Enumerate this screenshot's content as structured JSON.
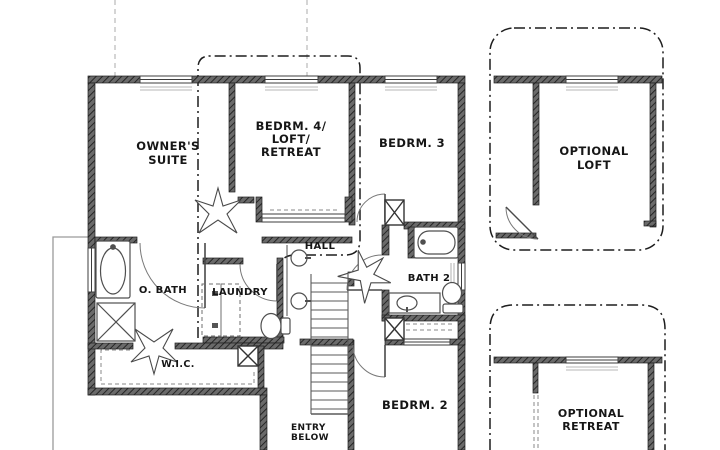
{
  "drawing_title": "second-floor-plan",
  "colors": {
    "wall_dark": "#4a4a4a",
    "wall_hatch_line": "#262626",
    "line_dark": "#1d1d1d",
    "fixture_line": "#5a5a5a",
    "guide_gray": "#b9b9b9",
    "background": "#ffffff"
  },
  "rooms": [
    {
      "id": "owners-suite",
      "lines": [
        "OWNER'S",
        "SUITE"
      ],
      "x": 168,
      "y": 150,
      "size": 11.5,
      "lh": 14,
      "anchor": "middle"
    },
    {
      "id": "bedrm4-loft-retreat",
      "lines": [
        "BEDRM. 4/",
        "LOFT/",
        "RETREAT"
      ],
      "x": 291,
      "y": 130,
      "size": 11.5,
      "lh": 13,
      "anchor": "middle"
    },
    {
      "id": "bedrm3",
      "lines": [
        "BEDRM. 3"
      ],
      "x": 412,
      "y": 147,
      "size": 11.5,
      "lh": 13,
      "anchor": "middle"
    },
    {
      "id": "optional-loft",
      "lines": [
        "OPTIONAL",
        "LOFT"
      ],
      "x": 594,
      "y": 155,
      "size": 11.5,
      "lh": 14,
      "anchor": "middle"
    },
    {
      "id": "hall",
      "lines": [
        "HALL"
      ],
      "x": 320,
      "y": 249,
      "size": 10,
      "lh": 11,
      "anchor": "middle"
    },
    {
      "id": "o-bath",
      "lines": [
        "O. BATH"
      ],
      "x": 163,
      "y": 293,
      "size": 10,
      "lh": 11,
      "anchor": "middle"
    },
    {
      "id": "laundry",
      "lines": [
        "LAUNDRY"
      ],
      "x": 240,
      "y": 295,
      "size": 10,
      "lh": 11,
      "anchor": "middle"
    },
    {
      "id": "bath2",
      "lines": [
        "BATH 2"
      ],
      "x": 429,
      "y": 281,
      "size": 10,
      "lh": 11,
      "anchor": "middle"
    },
    {
      "id": "wic",
      "lines": [
        "W.I.C."
      ],
      "x": 178,
      "y": 367,
      "size": 9.5,
      "lh": 10,
      "anchor": "middle"
    },
    {
      "id": "bedrm2",
      "lines": [
        "BEDRM. 2"
      ],
      "x": 415,
      "y": 409,
      "size": 11.5,
      "lh": 13,
      "anchor": "middle"
    },
    {
      "id": "entry-below",
      "lines": [
        "ENTRY",
        "BELOW"
      ],
      "x": 291,
      "y": 430,
      "size": 9,
      "lh": 10,
      "anchor": "start"
    },
    {
      "id": "optional-retreat",
      "lines": [
        "OPTIONAL",
        "RETREAT"
      ],
      "x": 591,
      "y": 417,
      "size": 11,
      "lh": 13,
      "anchor": "middle"
    }
  ]
}
